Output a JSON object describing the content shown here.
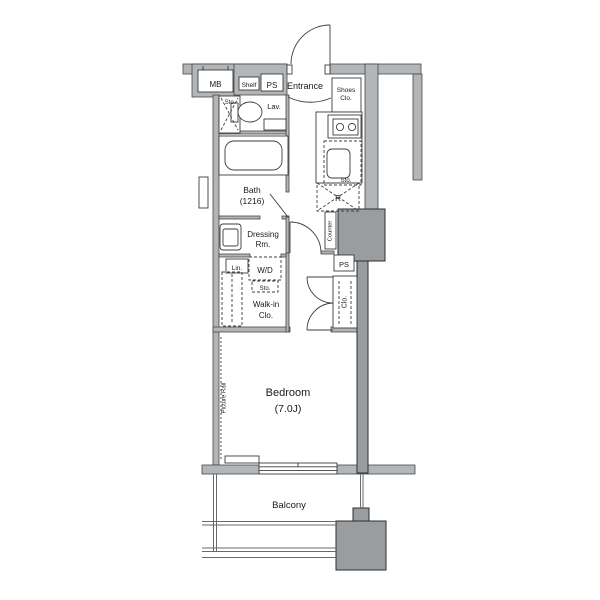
{
  "colors": {
    "wall": "#b3b6b8",
    "block": "#9a9da0",
    "line": "#3c3c3c",
    "text": "#1a1a1a",
    "background": "#ffffff"
  },
  "labels": {
    "mb": "MB",
    "shelf": "Shelf",
    "ps_top": "PS",
    "entrance": "Entrance",
    "shoes_clo_1": "Shoes",
    "shoes_clo_2": "Clo.",
    "sto_lav": "Sto.",
    "lav": "Lav.",
    "bath_1": "Bath",
    "bath_2": "(1216)",
    "dressing_1": "Dressing",
    "dressing_2": "Rm.",
    "lin": "Lin.",
    "wd": "W/D",
    "sto_wd": "Sto.",
    "walkin_1": "Walk-in",
    "walkin_2": "Clo.",
    "sto_kitchen": "Sto.",
    "fridge": "R",
    "counter": "Counter",
    "ps_mid": "PS",
    "clo": "Clo.",
    "picture_rail": "Picture Rail",
    "bedroom_1": "Bedroom",
    "bedroom_2": "(7.0J)",
    "balcony": "Balcony"
  }
}
